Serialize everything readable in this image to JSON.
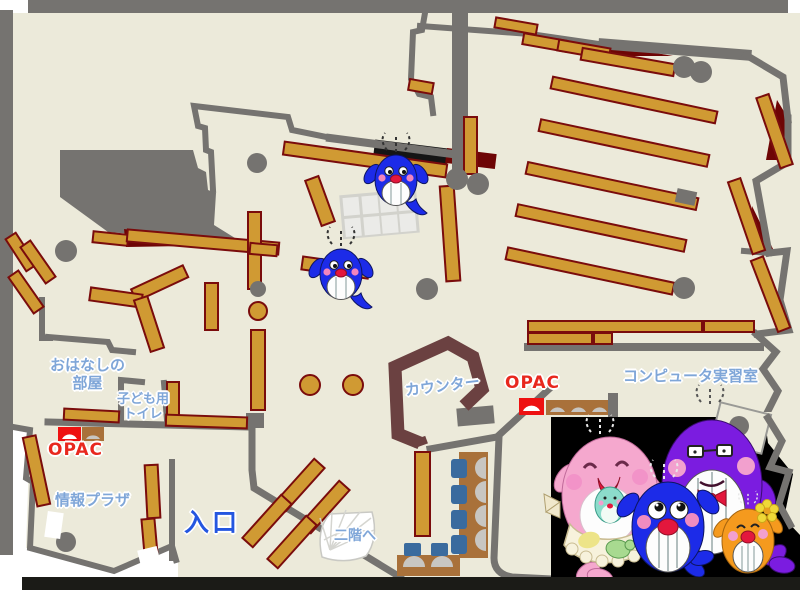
{
  "floor_map": {
    "rooms": {
      "storytelling_room": {
        "label_line1": "おはなしの",
        "label_line2": "部屋"
      },
      "kids_toilet": {
        "label_line1": "子ども用",
        "label_line2": "トイレ"
      },
      "info_plaza": {
        "label": "情報プラザ"
      },
      "entrance": {
        "label": "入口"
      },
      "counter": {
        "label": "カウンター"
      },
      "computer_room": {
        "label": "コンピュータ実習室"
      },
      "stairs_to_second_floor": {
        "label": "二階へ"
      }
    },
    "opac_terminals": {
      "left_label": "OPAC",
      "right_label": "OPAC"
    },
    "colors": {
      "floor": "#ECEADA",
      "wall_gray": "#757370",
      "shelf_gold": "#D09A33",
      "shelf_border": "#7A0C0C",
      "dark_red": "#6E0505",
      "counter_maroon": "#6B4141",
      "desk_brown": "#A9713A",
      "chair_blue": "#3A6B9E",
      "opac_red": "#EE1111",
      "label_blue": "#7FA6D8",
      "entrance_blue": "#2456E0",
      "label_red": "#E8281E",
      "mascot_panel": "#000000"
    },
    "mascots": {
      "map_sprites": [
        "blue-whale",
        "blue-whale"
      ],
      "family_panel": [
        "pink-whale-mother",
        "purple-whale-father",
        "blue-whale-child",
        "orange-whale-child"
      ]
    }
  }
}
